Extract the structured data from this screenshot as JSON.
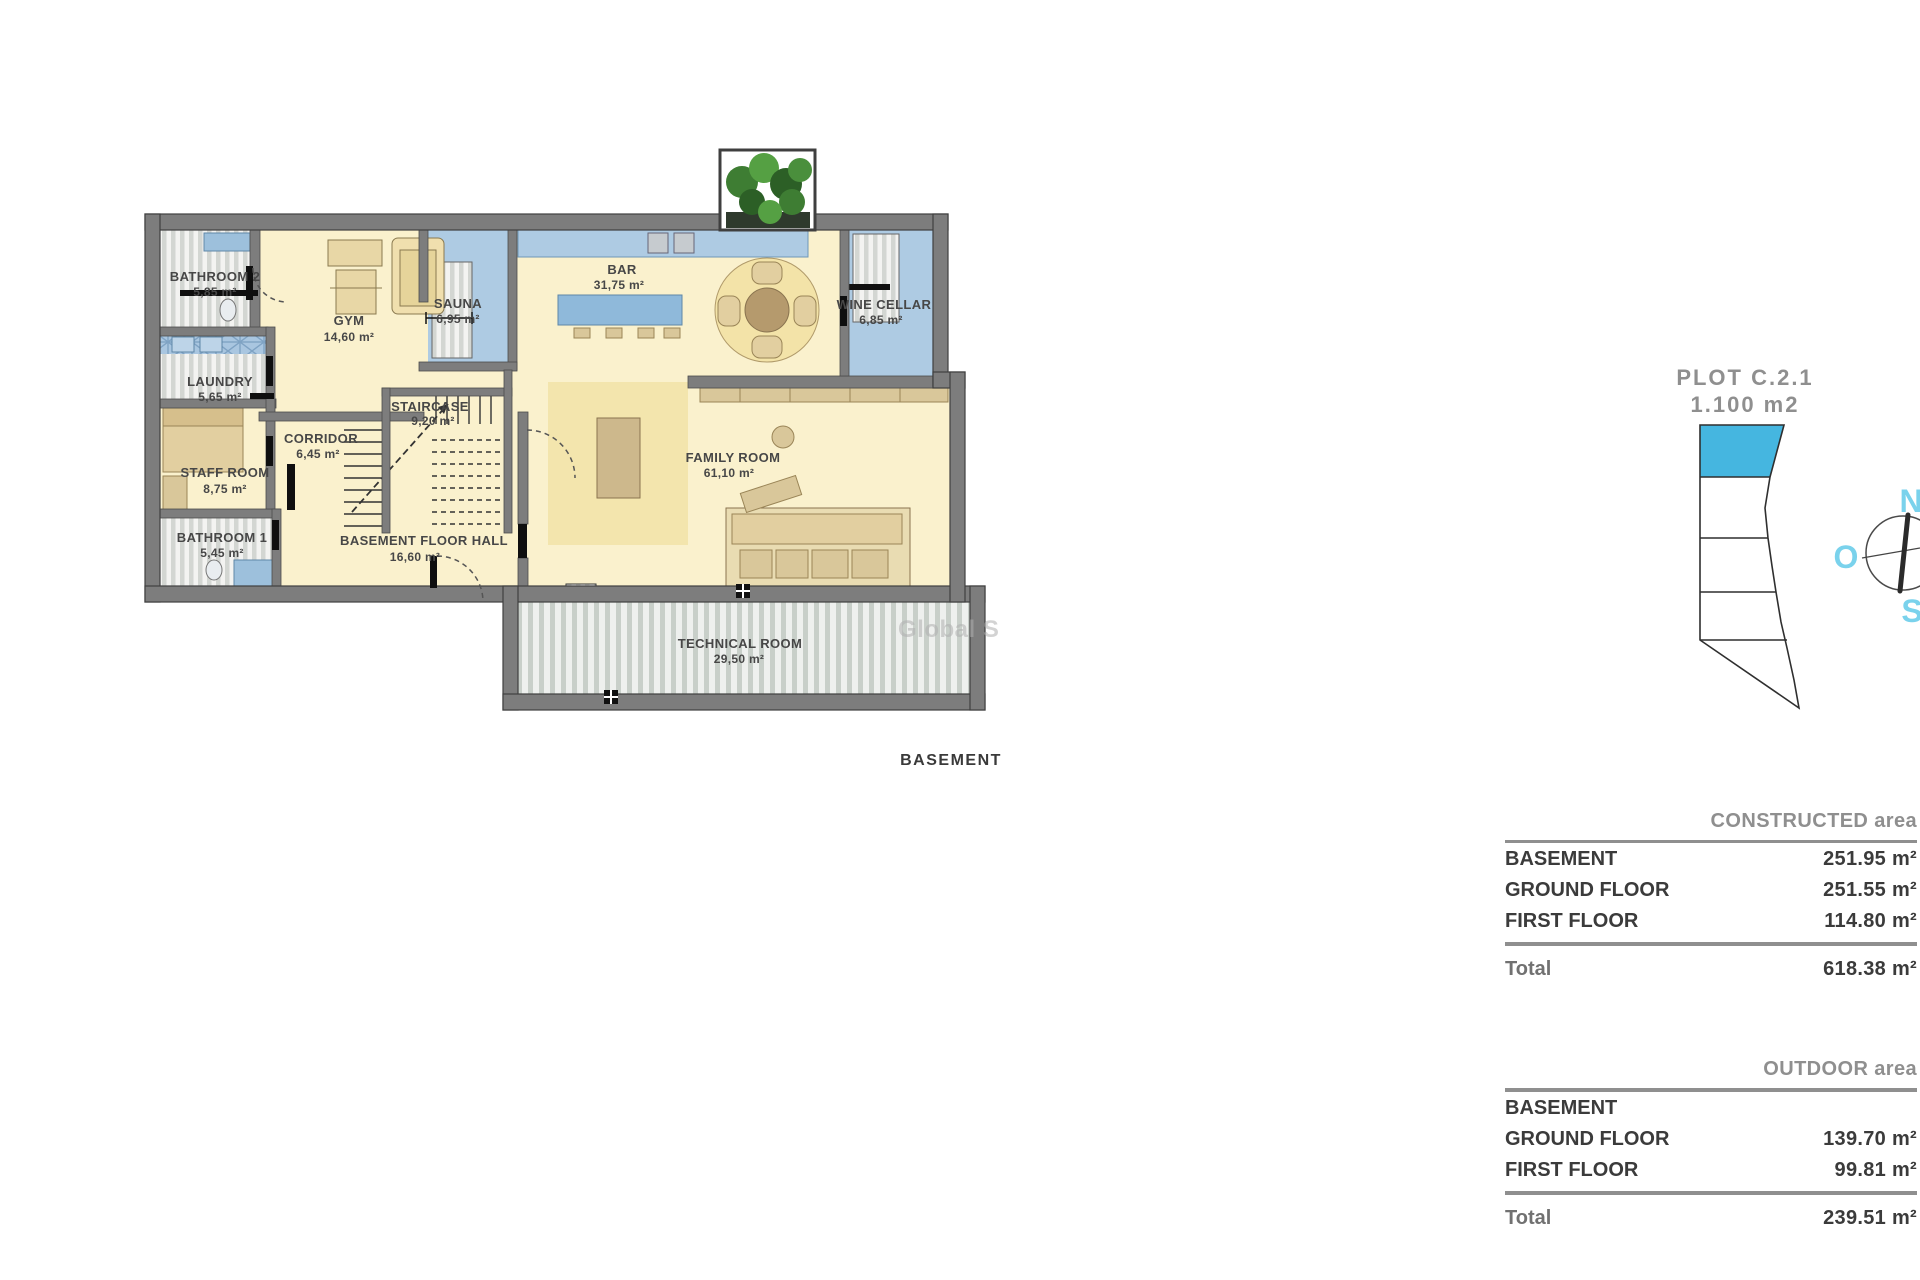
{
  "floor_plan": {
    "caption": "BASEMENT",
    "watermark": "Global S",
    "rooms": [
      {
        "name": "BATHROOM 2",
        "area": "5,85 m²"
      },
      {
        "name": "GYM",
        "area": "14,60 m²"
      },
      {
        "name": "SAUNA",
        "area": "6,95 m²"
      },
      {
        "name": "LAUNDRY",
        "area": "5,65 m²"
      },
      {
        "name": "CORRIDOR",
        "area": "6,45 m²"
      },
      {
        "name": "STAFF ROOM",
        "area": "8,75 m²"
      },
      {
        "name": "STAIRCASE",
        "area": "9,20 m²"
      },
      {
        "name": "BATHROOM 1",
        "area": "5,45 m²"
      },
      {
        "name": "BASEMENT FLOOR HALL",
        "area": "16,60 m²"
      },
      {
        "name": "BAR",
        "area": "31,75 m²"
      },
      {
        "name": "WINE CELLAR",
        "area": "6,85 m²"
      },
      {
        "name": "FAMILY ROOM",
        "area": "61,10 m²"
      },
      {
        "name": "TECHNICAL ROOM",
        "area": "29,50 m²"
      }
    ]
  },
  "plot": {
    "title": "PLOT C.2.1",
    "area": "1.100 m2"
  },
  "compass": {
    "north": "N",
    "west": "O",
    "south": "S"
  },
  "tables": {
    "constructed": {
      "header": "CONSTRUCTED area",
      "rows": [
        {
          "label": "BASEMENT",
          "value": "251.95 m²"
        },
        {
          "label": "GROUND FLOOR",
          "value": "251.55 m²"
        },
        {
          "label": "FIRST FLOOR",
          "value": "114.80 m²"
        }
      ],
      "total_label": "Total",
      "total_value": "618.38 m²"
    },
    "outdoor": {
      "header": "OUTDOOR area",
      "rows": [
        {
          "label": "BASEMENT",
          "value": ""
        },
        {
          "label": "GROUND FLOOR",
          "value": "139.70 m²"
        },
        {
          "label": "FIRST FLOOR",
          "value": "99.81 m²"
        }
      ],
      "total_label": "Total",
      "total_value": "239.51 m²"
    }
  },
  "colors": {
    "wall_gray": "#7d7d7d",
    "floor_cream": "#faf1cd",
    "fixture_blue": "#9dc0dc",
    "plot_blue": "#45b6e0",
    "compass_cyan": "#7ad2ec",
    "text_dark": "#3b3b3b",
    "text_gray": "#8f8f8f"
  }
}
